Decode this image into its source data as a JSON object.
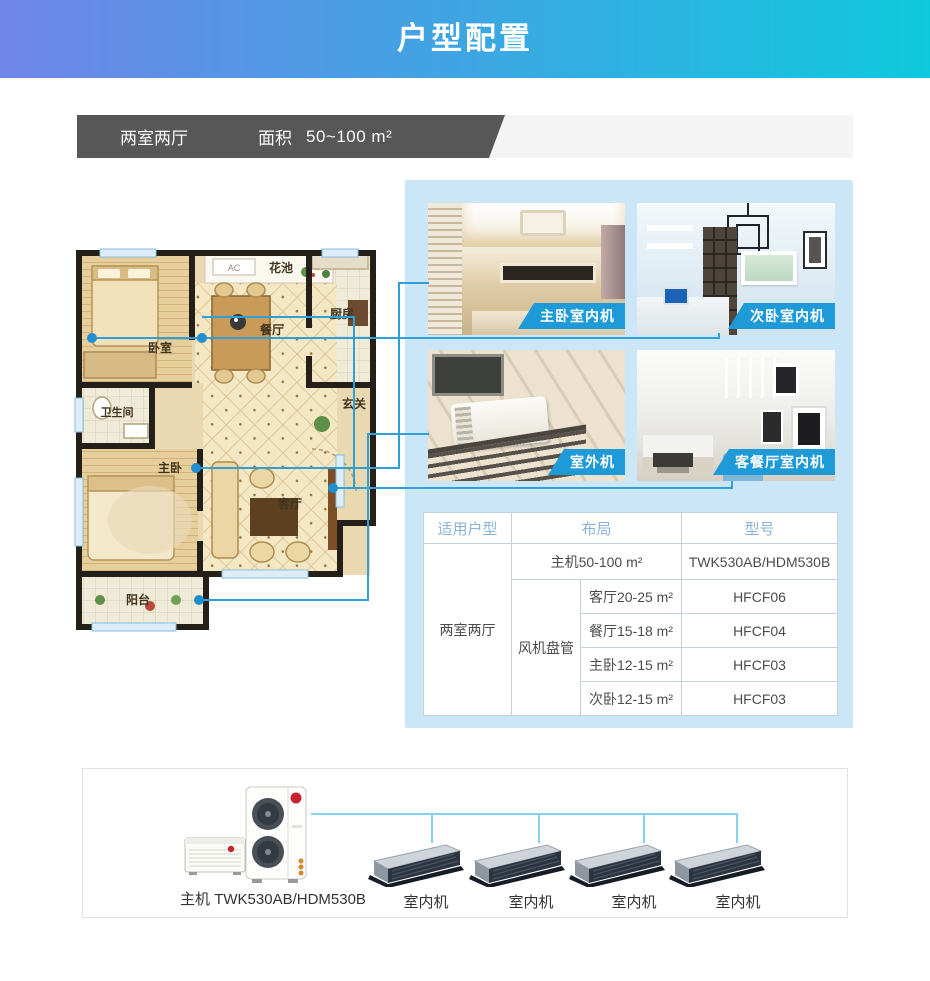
{
  "header": {
    "title": "户型配置"
  },
  "banner": {
    "unit_type": "两室两厅",
    "area_label": "面积",
    "area_value": "50~100 m²"
  },
  "floor_plan": {
    "rooms": {
      "flower_bed": "花池",
      "ac": "AC",
      "bedroom": "卧室",
      "dining": "餐厅",
      "kitchen": "厨房",
      "bathroom": "卫生间",
      "entry": "玄关",
      "master_bedroom": "主卧",
      "living": "客厅",
      "balcony": "阳台"
    }
  },
  "photos": {
    "master": "主卧室内机",
    "second": "次卧室内机",
    "outdoor": "室外机",
    "living_dining": "客餐厅室内机"
  },
  "spec_table": {
    "headers": {
      "unit_type": "适用户型",
      "layout": "布局",
      "model": "型号"
    },
    "unit_type": "两室两厅",
    "host": {
      "layout": "主机50-100 m²",
      "model": "TWK530AB/HDM530B"
    },
    "fan_coil_label": "风机盘管",
    "fan_coils": [
      {
        "layout": "客厅20-25 m²",
        "model": "HFCF06"
      },
      {
        "layout": "餐厅15-18 m²",
        "model": "HFCF04"
      },
      {
        "layout": "主卧12-15 m²",
        "model": "HFCF03"
      },
      {
        "layout": "次卧12-15 m²",
        "model": "HFCF03"
      }
    ]
  },
  "diagram": {
    "host_label": "主机 TWK530AB/HDM530B",
    "indoor_unit_labels": [
      "室内机",
      "室内机",
      "室内机",
      "室内机"
    ]
  },
  "colors": {
    "header_gradient_start": "#6f85e7",
    "header_gradient_end": "#0fc9de",
    "banner_dark": "#575757",
    "panel_blue": "#cbe7f7",
    "ribbon_blue": "#1e9ad9",
    "connector_blue": "#2f9fd8",
    "table_header_text": "#8ab4d8"
  }
}
